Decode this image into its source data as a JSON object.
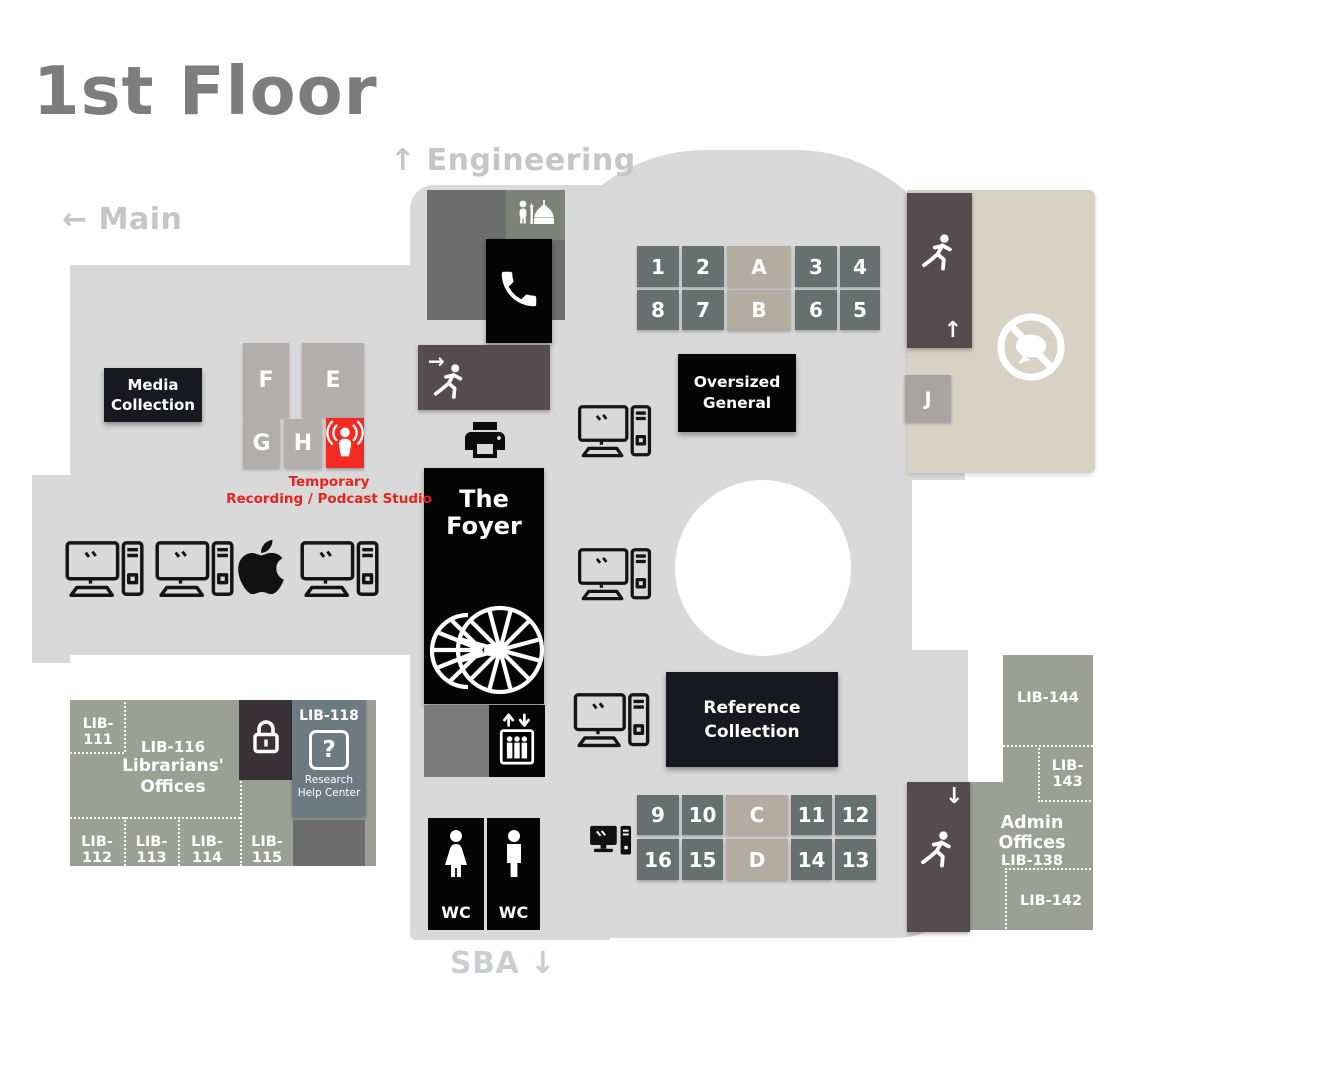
{
  "page": {
    "title": "1st Floor"
  },
  "directions": {
    "engineering": {
      "arrow": "↑",
      "label": "Engineering"
    },
    "main": {
      "arrow": "←",
      "label": "Main"
    },
    "sba": {
      "arrow": "↓",
      "label": "SBA"
    }
  },
  "shelves": {
    "top_row1": [
      "1",
      "2",
      "A",
      "3",
      "4"
    ],
    "top_row2": [
      "8",
      "7",
      "B",
      "6",
      "5"
    ],
    "bottom_row1": [
      "9",
      "10",
      "C",
      "11",
      "12"
    ],
    "bottom_row2": [
      "16",
      "15",
      "D",
      "14",
      "13"
    ],
    "study_row1": [
      "F",
      "E"
    ],
    "study_row2": [
      "G",
      "H"
    ],
    "j": "J"
  },
  "labels": {
    "media_collection_1": "Media",
    "media_collection_2": "Collection",
    "oversized_1": "Oversized",
    "oversized_2": "General",
    "reference_1": "Reference",
    "reference_2": "Collection",
    "foyer_1": "The",
    "foyer_2": "Foyer",
    "wc": "WC",
    "podcast_note_1": "Temporary",
    "podcast_note_2": "Recording / Podcast Studio",
    "lib111": "LIB-111",
    "lib112": "LIB-112",
    "lib113": "LIB-113",
    "lib114": "LIB-114",
    "lib115": "LIB-115",
    "librarians_id": "LIB-116",
    "librarians_1": "Librarians'",
    "librarians_2": "Offices",
    "research_id": "LIB-118",
    "research_icon": "?",
    "research_1": "Research",
    "research_2": "Help Center",
    "admin_title": "Admin Offices",
    "admin_id": "LIB-138",
    "lib142": "LIB-142",
    "lib143": "LIB-143",
    "lib144": "LIB-144"
  },
  "icons": {
    "prayer_room": "person-mosque-icon",
    "phone": "phone-icon",
    "emergency_exit": "running-person-exit-icon",
    "printer": "printer-icon",
    "spiral_stairs": "spiral-staircase-icon",
    "elevator": "elevator-icon",
    "wc_female": "female-icon",
    "wc_male": "male-icon",
    "computer": "desktop-computer-icon",
    "mac": "apple-logo-icon",
    "podcast": "podcast-icon",
    "lock": "lock-icon",
    "research_help": "question-mark-icon",
    "quiet_zone": "no-talking-icon"
  },
  "colors": {
    "floor": "#d9d9d9",
    "quiet_zone": "#d7d2c4",
    "offices": "#9ba095",
    "shelf": "#66706f",
    "shelf_alt": "#b5aca1",
    "exit": "#564b4e",
    "dark_box": "#181821",
    "podcast_red": "#f42a22",
    "note_red": "#e8231b",
    "lib118_blue": "#6e7a82"
  }
}
